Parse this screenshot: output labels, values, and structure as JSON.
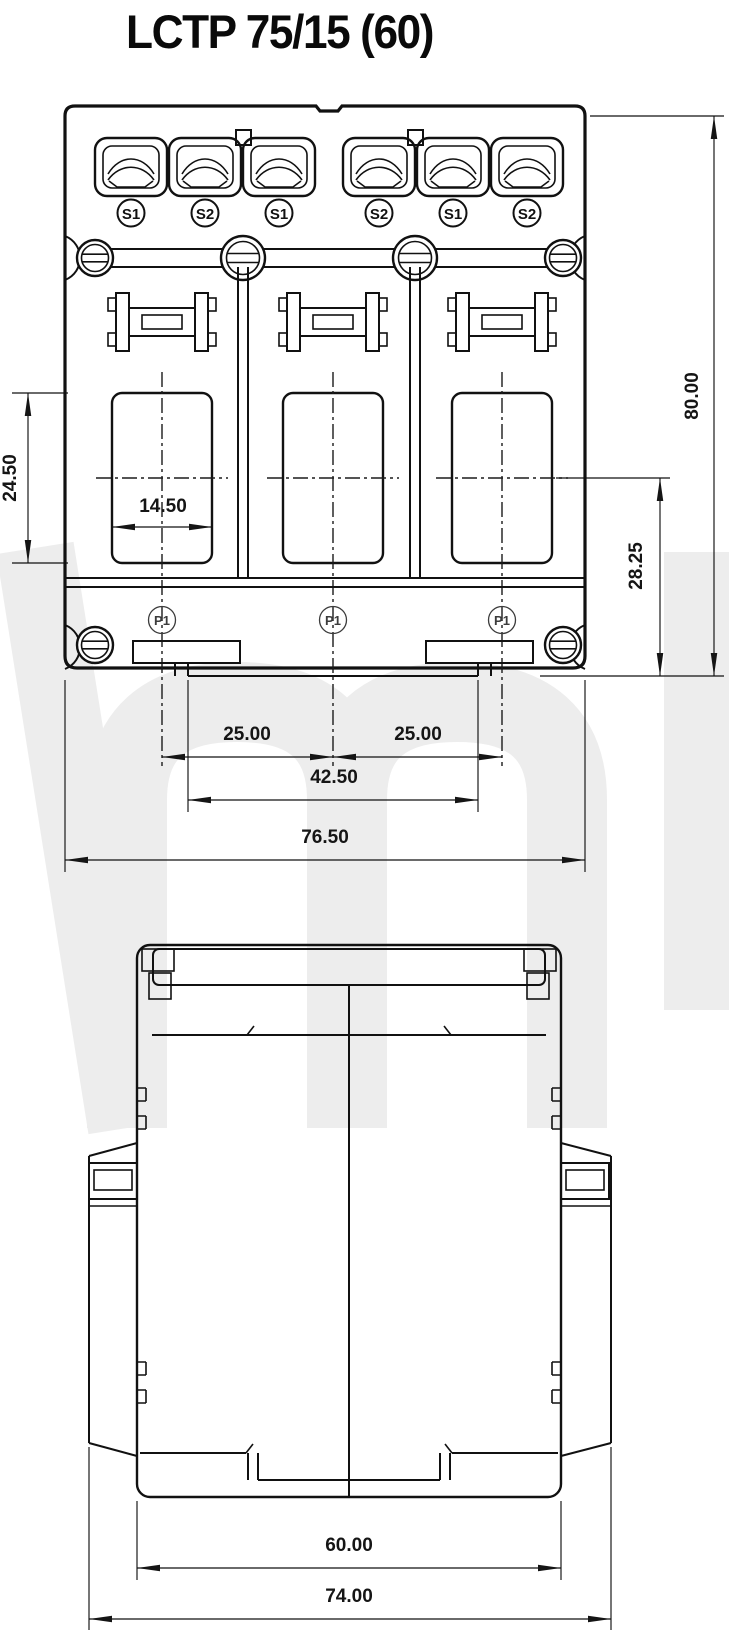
{
  "title": "LCTP 75/15 (60)",
  "watermark_color": "#ededed",
  "front_view": {
    "terminal_labels": [
      "S1",
      "S2",
      "S1",
      "S2",
      "S1",
      "S2"
    ],
    "primary_labels": [
      "P1",
      "P1",
      "P1"
    ],
    "dimensions": {
      "window_height": "24.50",
      "window_width": "14.50",
      "overall_height": "80.00",
      "center_to_bottom": "28.25",
      "pitch_left": "25.00",
      "pitch_right": "25.00",
      "clip_span": "42.50",
      "overall_width": "76.50"
    }
  },
  "side_view": {
    "dimensions": {
      "body_width": "60.00",
      "overall_width": "74.00"
    }
  }
}
